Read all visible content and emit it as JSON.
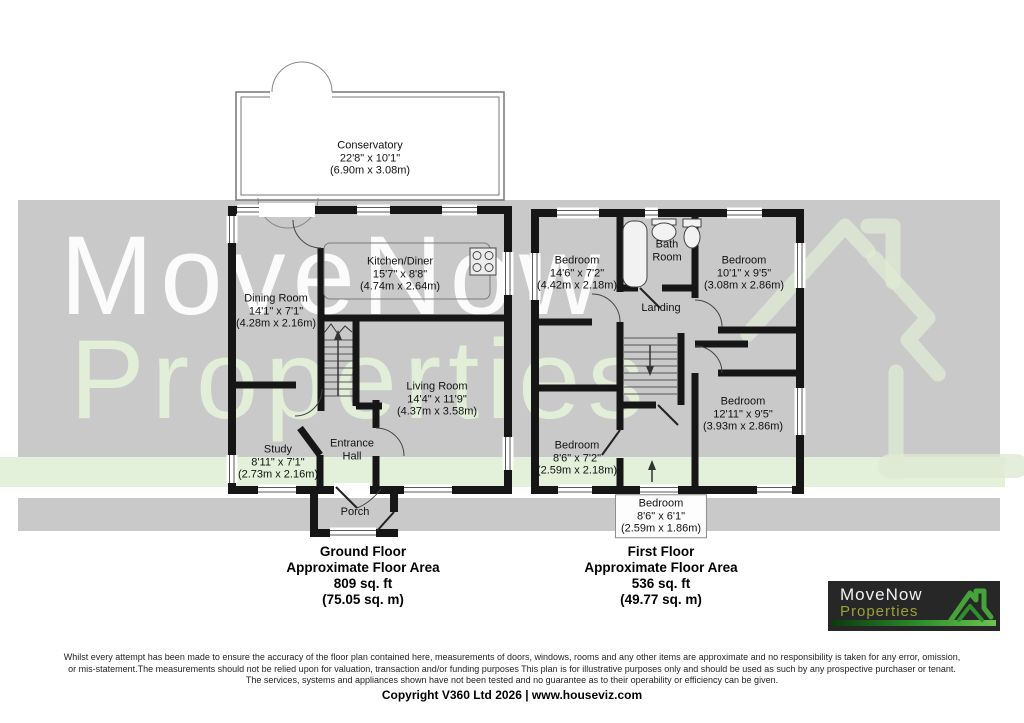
{
  "watermark": {
    "line1": "MoveNow",
    "line2": "Properties"
  },
  "colors": {
    "wall": "#161616",
    "band_gray": "#c9c9c9",
    "band_green": "#e3f0da",
    "watermark_white": "#ffffff",
    "watermark_green": "#e4f0d8",
    "logo_bg": "#272727",
    "logo_properties_green": "#9aa03c",
    "logo_accent_green": "#46a33c"
  },
  "icons": {
    "hob": "hob-icon",
    "bathtub": "bathtub-icon",
    "basin": "basin-icon",
    "toilet": "toilet-icon",
    "stairs_up_arrow": "stairs-up-arrow-icon",
    "stairs_down_arrow": "stairs-down-arrow-icon",
    "watermark_house": "house-ribbon-watermark-icon",
    "logo_house": "house-ribbon-icon"
  },
  "ground_floor": {
    "title": "Ground Floor",
    "subtitle": "Approximate Floor Area",
    "area_imperial": "809 sq. ft",
    "area_metric": "(75.05 sq. m)",
    "rooms": [
      {
        "name": "Conservatory",
        "dims": "22'8\" x 10'1\"",
        "metric": "(6.90m x 3.08m)"
      },
      {
        "name": "Kitchen/Diner",
        "dims": "15'7\" x 8'8\"",
        "metric": "(4.74m x 2.64m)"
      },
      {
        "name": "Dining Room",
        "dims": "14'1\" x 7'1\"",
        "metric": "(4.28m x 2.16m)"
      },
      {
        "name": "Living Room",
        "dims": "14'4\" x 11'9\"",
        "metric": "(4.37m x 3.58m)"
      },
      {
        "name": "Study",
        "dims": "8'11\" x 7'1\"",
        "metric": "(2.73m x 2.16m)"
      },
      {
        "line1": "Entrance",
        "line2": "Hall"
      },
      {
        "name": "Porch"
      }
    ]
  },
  "first_floor": {
    "title": "First Floor",
    "subtitle": "Approximate Floor Area",
    "area_imperial": "536 sq. ft",
    "area_metric": "(49.77 sq. m)",
    "rooms": [
      {
        "name": "Bedroom",
        "dims": "14'6\" x 7'2\"",
        "metric": "(4.42m x 2.18m)"
      },
      {
        "line1": "Bath",
        "line2": "Room"
      },
      {
        "name": "Bedroom",
        "dims": "10'1\" x 9'5\"",
        "metric": "(3.08m x 2.86m)"
      },
      {
        "name": "Landing"
      },
      {
        "name": "Bedroom",
        "dims": "12'11\" x 9'5\"",
        "metric": "(3.93m x 2.86m)"
      },
      {
        "name": "Bedroom",
        "dims": "8'6\" x 7'2\"",
        "metric": "(2.59m x 2.18m)"
      },
      {
        "name": "Bedroom",
        "dims": "8'6\" x 6'1\"",
        "metric": "(2.59m x 1.86m)"
      }
    ]
  },
  "logo": {
    "line1": "MoveNow",
    "line2": "Properties"
  },
  "footer": {
    "line1": "Whilst every attempt has been made to ensure the accuracy of the floor plan contained here, measurements of doors, windows, rooms and any other items are approximate and no responsibility is taken for any error, omission,",
    "line2": "or mis-statement.The measurements should not be relied upon for valuation, transaction and/or funding purposes This plan is for illustrative purposes only and should be used as such by any prospective purchaser or tenant.",
    "line3": "The services, systems and appliances shown have not been tested and no guarantee as to their operability or efficiency can be given.",
    "copyright": "Copyright V360 Ltd 2026 | www.houseviz.com"
  }
}
